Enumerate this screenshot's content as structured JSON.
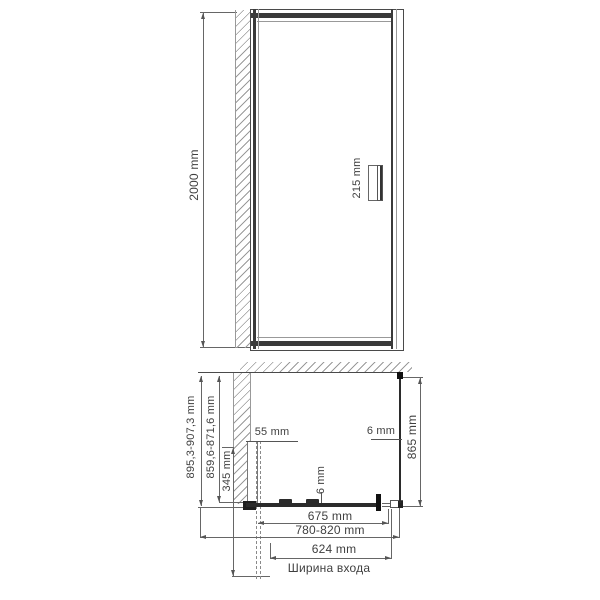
{
  "drawing_type": "shower-door technical dimension drawing",
  "front_view": {
    "height_dim": "2000 mm",
    "handle_dim": "215 mm"
  },
  "plan_view": {
    "total_depth_dim": "895,3-907,3 mm",
    "glass_depth_dim": "859,6-871,6 mm",
    "door_swing_dim": "345 mm",
    "wall_profile_dim": "55 mm",
    "door_glass_thickness_dim": "6 mm",
    "side_glass_thickness_dim": "6 mm",
    "side_panel_depth_dim": "865 mm",
    "door_glass_width_dim": "675 mm",
    "door_width_range_dim": "780-820 mm",
    "entry_width_dim": "624 mm",
    "entry_width_caption": "Ширина входа"
  },
  "colors": {
    "background": "#ffffff",
    "structure_line": "#3a3a3a",
    "dimension_line": "#666666",
    "hatch_line": "#9a9a9a",
    "text": "#3f3f3f"
  }
}
